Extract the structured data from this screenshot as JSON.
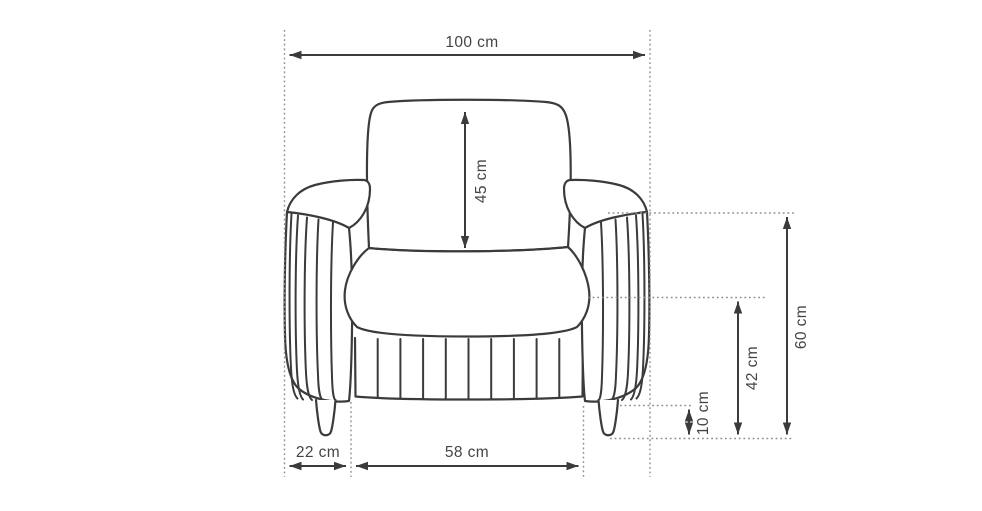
{
  "figure": {
    "name": "armchair-front-view-line-drawing",
    "type": "technical-dimension-diagram"
  },
  "labels": {
    "overall_width": "100 cm",
    "backrest_cushion_height": "45 cm",
    "armrest_width": "22 cm",
    "seat_width": "58 cm",
    "leg_height": "10 cm",
    "seat_height": "42 cm",
    "armrest_height": "60 cm"
  },
  "values_cm": {
    "overall_width": 100,
    "backrest_cushion_height": 45,
    "armrest_width": 22,
    "seat_width": 58,
    "leg_height": 10,
    "seat_height": 42,
    "armrest_height": 60
  },
  "colors": {
    "outline": "#3b3b3b",
    "extension_lines": "#8f8f8f",
    "label_text": "#444444",
    "background": "#ffffff"
  }
}
